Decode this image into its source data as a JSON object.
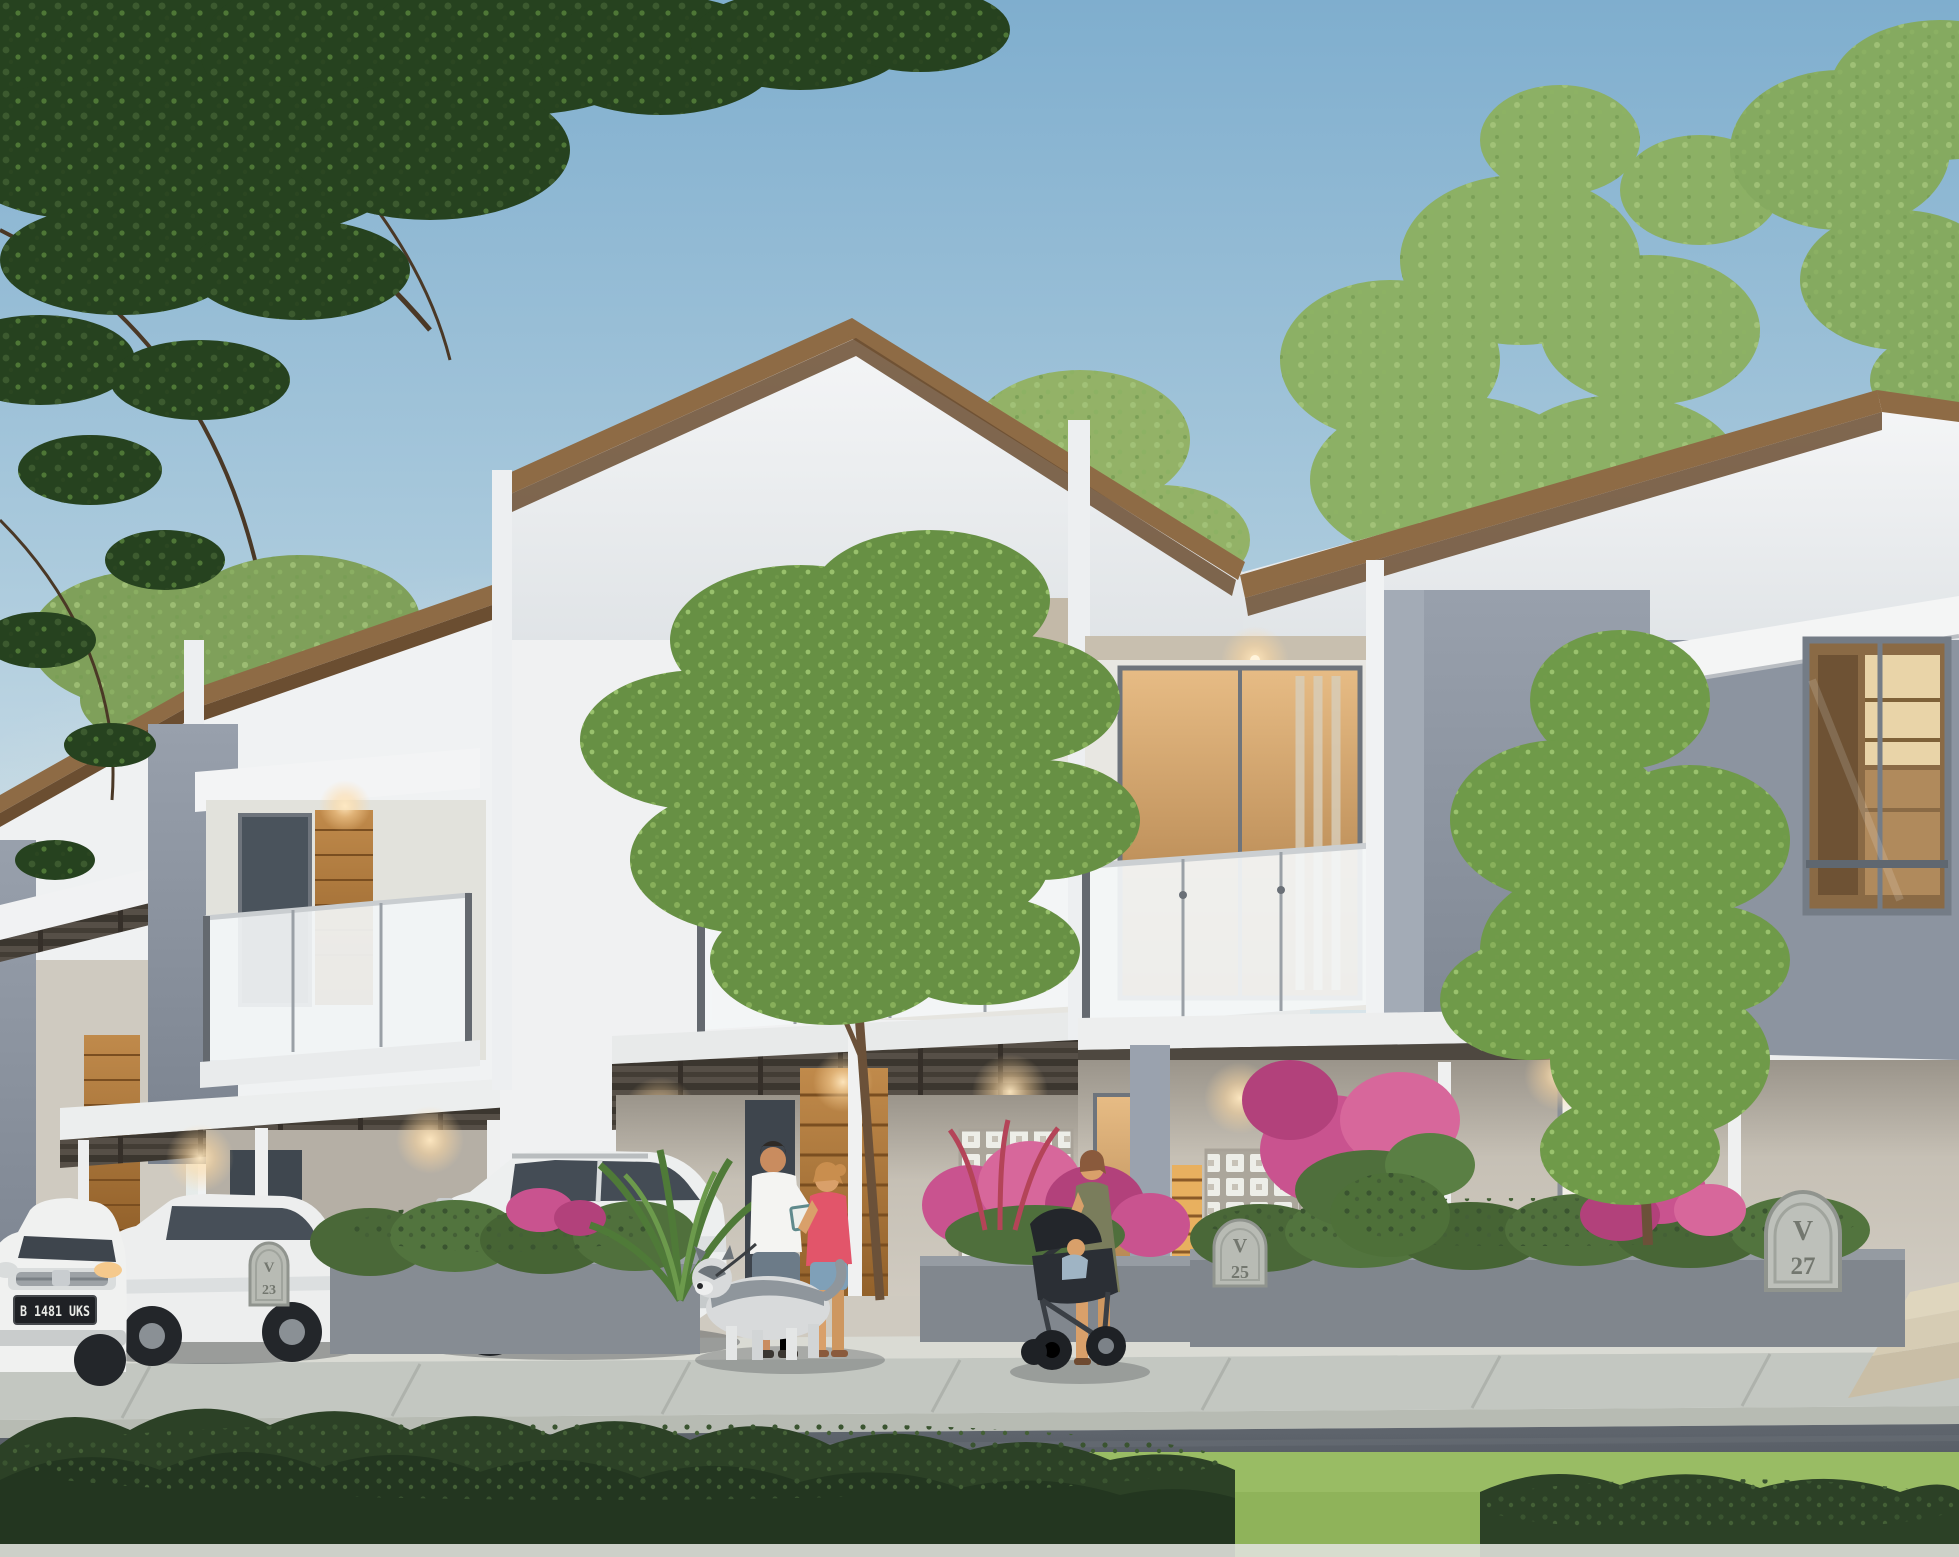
{
  "meta": {
    "title": "Modern townhouse row exterior rendering",
    "scene_type": "architectural rendering, dusk, street-front view of two-story cluster homes"
  },
  "palette": {
    "sky_top": "#7FAECE",
    "sky_horizon": "#EDF0EE",
    "roof_fascia_wood": "#8E6B45",
    "wall_white": "#F2F3F4",
    "accent_gray": "#8C94A2",
    "door_wood": "#B0763A",
    "warm_light": "#FFD9A8",
    "hedge_green": "#4F6F3C",
    "foreground_bush": "#2C4126",
    "lawn_green": "#86A858",
    "road_asphalt": "#50565E",
    "sidewalk": "#C6CAC4",
    "flower_pink": "#C9538F"
  },
  "houses": {
    "style": "two-story townhouses with mono-pitch wood-trimmed roofs, frosted glass balconies, breeze-block screens, carport canopies",
    "units": [
      {
        "id": "far-left-unit",
        "plaque_label": ""
      },
      {
        "id": "left-unit",
        "plaque_label": "V 23"
      },
      {
        "id": "center-unit",
        "plaque_label": "V 25"
      },
      {
        "id": "right-unit",
        "plaque_label": "V 27"
      }
    ]
  },
  "plaques": [
    {
      "line1": "V",
      "line2": "23"
    },
    {
      "line1": "V",
      "line2": "25"
    },
    {
      "line1": "V",
      "line2": "27"
    }
  ],
  "vehicles": [
    {
      "id": "white-mpv-front-view",
      "license_plate": "B 1481 UKS"
    },
    {
      "id": "white-mpv-side-view",
      "license_plate": ""
    },
    {
      "id": "white-suv-side-view",
      "license_plate": ""
    }
  ],
  "people": [
    {
      "id": "man-reading",
      "description": "man in white t-shirt and gray shorts holding a book"
    },
    {
      "id": "woman-coral-top",
      "description": "woman in coral tank top and denim shorts"
    },
    {
      "id": "woman-with-stroller",
      "description": "woman in olive dress pushing a black stroller with a baby"
    }
  ],
  "animals": [
    {
      "id": "husky-dog",
      "description": "gray and white husky on a leash"
    }
  ],
  "landscape": [
    "overhanging dark green tree branches top left",
    "background trees behind roofline",
    "small tree in front garden planter",
    "tall slender tree in front of right unit",
    "pink and magenta flowering shrubs",
    "hedge-topped concrete planters",
    "dark green foreground bushes and bright lawn strip",
    "sidewalk, curb and asphalt road"
  ]
}
